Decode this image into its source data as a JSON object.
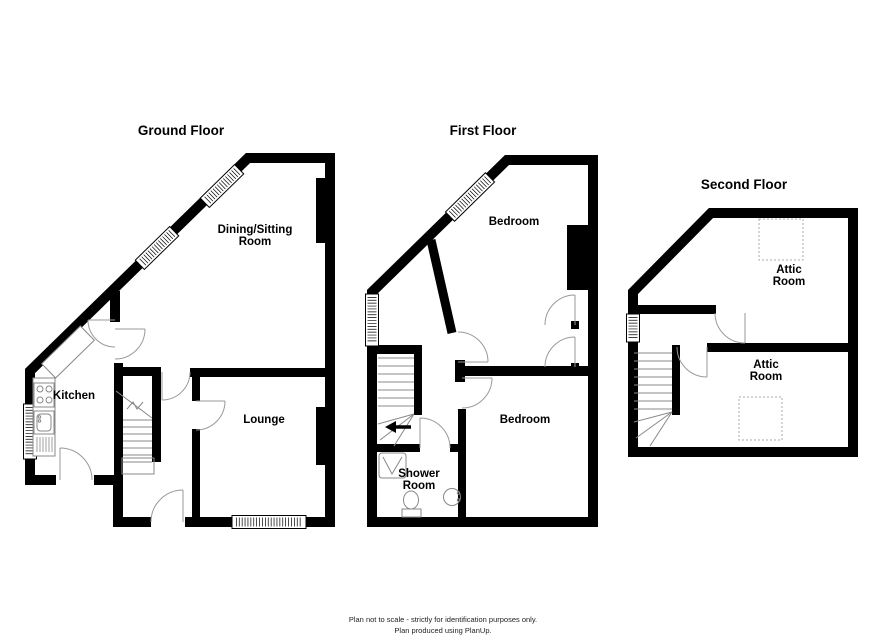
{
  "floors": [
    {
      "title": "Ground Floor",
      "rooms": [
        {
          "label": "Dining/Sitting Room"
        },
        {
          "label": "Kitchen"
        },
        {
          "label": "Lounge"
        }
      ]
    },
    {
      "title": "First Floor",
      "rooms": [
        {
          "label": "Bedroom"
        },
        {
          "label": "Bedroom"
        },
        {
          "label": "Shower Room"
        }
      ]
    },
    {
      "title": "Second Floor",
      "rooms": [
        {
          "label": "Attic Room"
        },
        {
          "label": "Attic Room"
        }
      ]
    }
  ],
  "footer": {
    "line1": "Plan not to scale - strictly for identification purposes only.",
    "line2": "Plan produced using PlanUp."
  },
  "colors": {
    "wall": "#000000",
    "door_line": "#9a9a9a",
    "stair_line": "#888888",
    "skylight_line": "#aaaaaa",
    "background": "#ffffff"
  }
}
